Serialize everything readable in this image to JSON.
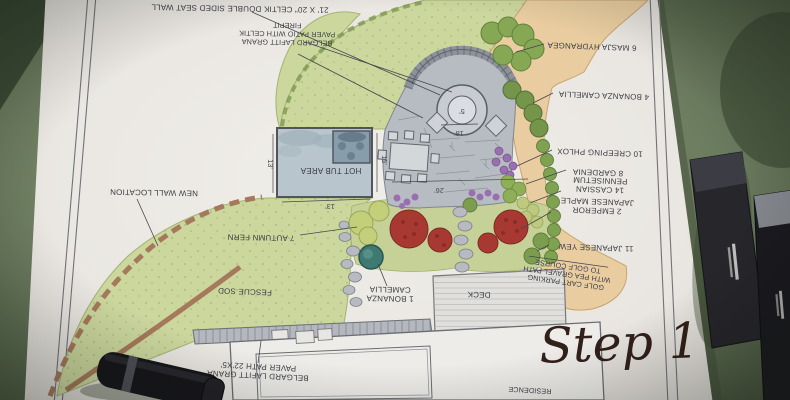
{
  "photo": {
    "step_label": "Step 1",
    "objects": [
      "marker-pen-bottom-left",
      "marker-pen-right-1",
      "marker-pen-right-2"
    ]
  },
  "plan": {
    "labels": {
      "seat_wall": "21' X 20\" CELTIK DOUBLE SIDED SEAT WALL",
      "firepit_patio": [
        "BELGARD LAFITT GRANA",
        "PAVER PATIO WITH CELTIK",
        "FIREPIT"
      ],
      "hydrangea": "6 MASJA HYDRANGEA",
      "camellia_4": "4 BONANZA CAMELLIA",
      "phlox": "10 CREEPING PHLOX",
      "gardenia": "8 GARDENIA",
      "pennisetum": [
        "14 CASSIAN",
        "PENNISETUM"
      ],
      "maple": [
        "2 EMPEROR",
        "JAPANESE MAPLE"
      ],
      "yew": "11 JAPANESE YEW",
      "golf": [
        "GOLF CART PARKING",
        "WITH PEA GRAVEL PATH",
        "TO GOLF COURSE"
      ],
      "new_wall": "NEW WALL LOCATION",
      "autumn_fern": "7 AUTUMN FERN",
      "fescue_sod": "FESCUE SOD",
      "hot_tub": "HOT TUB AREA",
      "camellia_1": [
        "1 BONANZA",
        "CAMELLIA"
      ],
      "deck": "DECK",
      "paver_path": [
        "BELGARD LAFITT GRANA",
        "PAVER PATH 22'X5'"
      ],
      "residence": "RESIDENCE"
    },
    "dimensions": {
      "firepit": "5'",
      "patio_depth": "18'",
      "patio_width": "26'",
      "hot_tub_left": "13'",
      "hot_tub_right": "15'",
      "hot_tub_bottom": "13'"
    }
  },
  "colors": {
    "table_green": "#6f7f63",
    "paper": "#ebe9e5",
    "lawn": "#ccd79e",
    "path_tan": "#e9cda0",
    "patio_gray": "#b7bcc3",
    "hot_tub_blue": "#b8c5cd",
    "maple_red": "#a83832",
    "wall_brown": "#a5795b",
    "ink": "#3b3d44",
    "step_text": "#32201a"
  }
}
